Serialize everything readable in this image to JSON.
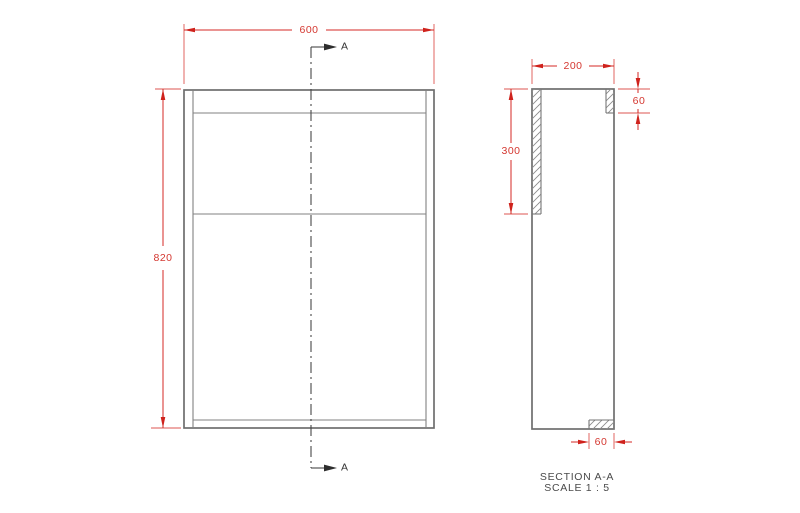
{
  "drawing": {
    "front_view": {
      "width_dim": "600",
      "height_dim": "820",
      "section_marker_top": "A",
      "section_marker_bottom": "A"
    },
    "section_view": {
      "depth_dim": "200",
      "panel_length_dim": "300",
      "top_rail_dim": "60",
      "bottom_rail_dim": "60",
      "title": "SECTION A-A",
      "scale": "SCALE 1 : 5"
    },
    "colors": {
      "dimension_red": "#d42a24",
      "drawing_gray": "#6e6e6e",
      "annotation_dark": "#333333",
      "background": "#ffffff"
    }
  }
}
